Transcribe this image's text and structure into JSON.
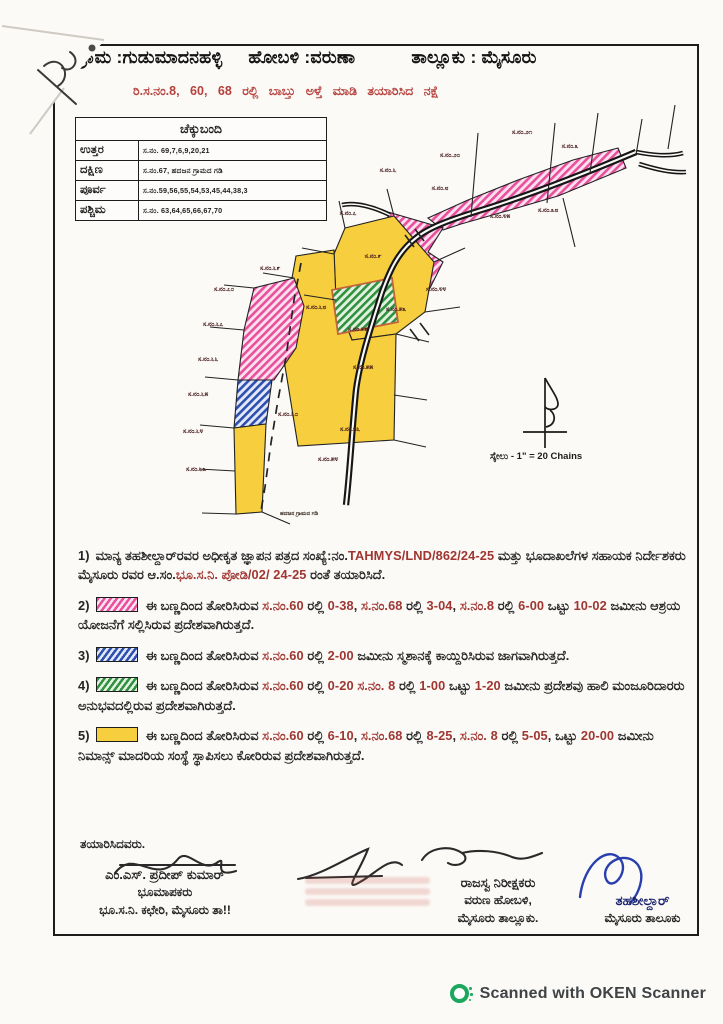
{
  "header": {
    "village": "ಗ್ರಾಮ :ಗುಡುಮಾದನಹಳ್ಳಿ",
    "hobli": "ಹೋಬಳಿ :ವರುಣಾ",
    "taluk": "ತಾಲ್ಲೂಕು : ಮೈಸೂರು",
    "subtitle": "ರಿ.ಸ.ನಂ.8, 60, 68 ರಲ್ಲಿ ಬಾಬ್ತು ಅಳ್ತೆ ಮಾಡಿ ತಯಾರಿಸಿದ ನಕ್ಷೆ"
  },
  "checkbandi": {
    "title": "ಚೆಕ್ಕುಬಂದಿ",
    "rows": [
      {
        "label": "ಉತ್ತರ",
        "value": "ಸ.ನಂ. 69,7,6,9,20,21"
      },
      {
        "label": "ದಕ್ಷಿಣ",
        "value": "ಸ.ನಂ.67, ಹದಜನ ಗ್ರಾಮದ ಗಡಿ"
      },
      {
        "label": "ಪೂರ್ವ",
        "value": "ಸ.ನಂ.59,56,55,54,53,45,44,38,3"
      },
      {
        "label": "ಪಶ್ಚಿಮ",
        "value": "ಸ.ನಂ. 63,64,65,66,67,70"
      }
    ]
  },
  "map": {
    "scale_label": "ಸ್ಕೇಲು - 1\" = 20 Chains",
    "boundary_note": "ಹದಜನ ಗ್ರಾಮದ ಗಡಿ",
    "colors": {
      "pink": "#e8509d",
      "blue": "#2f4fae",
      "green": "#2f9140",
      "yellow": "#f6ce3e"
    },
    "labels": [
      {
        "x": 330,
        "y": 77,
        "t": "ಸ.ನಂ.೬"
      },
      {
        "x": 392,
        "y": 62,
        "t": "ಸ.ನಂ.೨೦"
      },
      {
        "x": 464,
        "y": 39,
        "t": "ಸ.ನಂ.೨೧"
      },
      {
        "x": 512,
        "y": 53,
        "t": "ಸ.ನಂ.೩"
      },
      {
        "x": 290,
        "y": 120,
        "t": "ಸ.ನಂ.೭"
      },
      {
        "x": 382,
        "y": 95,
        "t": "ಸ.ನಂ.೮"
      },
      {
        "x": 442,
        "y": 123,
        "t": "ಸ.ನಂ.೪೫"
      },
      {
        "x": 490,
        "y": 117,
        "t": "ಸ.ನಂ.೩೮"
      },
      {
        "x": 378,
        "y": 196,
        "t": "ಸ.ನಂ.೪೪"
      },
      {
        "x": 315,
        "y": 163,
        "t": "ಸ.ನಂ.೯"
      },
      {
        "x": 212,
        "y": 175,
        "t": "ಸ.ನಂ.೬೯"
      },
      {
        "x": 166,
        "y": 196,
        "t": "ಸ.ನಂ.೭೦"
      },
      {
        "x": 155,
        "y": 231,
        "t": "ಸ.ನಂ.೬೭"
      },
      {
        "x": 150,
        "y": 266,
        "t": "ಸ.ನಂ.೬೬"
      },
      {
        "x": 140,
        "y": 301,
        "t": "ಸ.ನಂ.೬೫"
      },
      {
        "x": 135,
        "y": 338,
        "t": "ಸ.ನಂ.೬೪"
      },
      {
        "x": 138,
        "y": 376,
        "t": "ಸ.ನಂ.೬೩"
      },
      {
        "x": 258,
        "y": 214,
        "t": "ಸ.ನಂ.೬೮"
      },
      {
        "x": 230,
        "y": 321,
        "t": "ಸ.ನಂ.೬೦"
      },
      {
        "x": 338,
        "y": 216,
        "t": "ಸ.ನಂ.೫೩"
      },
      {
        "x": 300,
        "y": 236,
        "t": "ಸ.ನಂ.೫೯"
      },
      {
        "x": 305,
        "y": 274,
        "t": "ಸ.ನಂ.೫೫"
      },
      {
        "x": 292,
        "y": 336,
        "t": "ಸ.ನಂ.೫೬"
      },
      {
        "x": 270,
        "y": 366,
        "t": "ಸ.ನಂ.೫೪"
      }
    ]
  },
  "notes": [
    {
      "num": "1)",
      "swatch": null,
      "segments": [
        {
          "t": "ಮಾನ್ಯ ತಹಶೀಲ್ದಾರ್‌ರವರ ಅಧೀಕೃತ ಜ್ಞಾಪನ ಪತ್ರದ ಸಂಖ್ಯೆ:ನಂ.",
          "r": false
        },
        {
          "t": "TAHMYS/LND/862/24-25",
          "r": true
        },
        {
          "t": " ಮತ್ತು ಭೂದಾಖಲೆಗಳ ಸಹಾಯಕ ನಿರ್ದೇಶಕರು ಮೈಸೂರು ರವರ ಆ.ಸಂ.",
          "r": false
        },
        {
          "t": "ಭೂ.ಸ.ನಿ. ಪೋಡಿ/02/ 24-25",
          "r": true
        },
        {
          "t": " ರಂತೆ ತಯಾರಿಸಿದೆ.",
          "r": false
        }
      ]
    },
    {
      "num": "2)",
      "swatch": "pink",
      "segments": [
        {
          "t": "ಈ ಬಣ್ಣದಿಂದ ತೋರಿಸಿರುವ ",
          "r": false
        },
        {
          "t": "ಸ.ನಂ.60",
          "r": true
        },
        {
          "t": " ರಲ್ಲಿ ",
          "r": false
        },
        {
          "t": "0-38",
          "r": true
        },
        {
          "t": ", ",
          "r": false
        },
        {
          "t": "ಸ.ನಂ.68",
          "r": true
        },
        {
          "t": " ರಲ್ಲಿ ",
          "r": false
        },
        {
          "t": "3-04",
          "r": true
        },
        {
          "t": ", ",
          "r": false
        },
        {
          "t": "ಸ.ನಂ.8",
          "r": true
        },
        {
          "t": " ರಲ್ಲಿ ",
          "r": false
        },
        {
          "t": "6-00",
          "r": true
        },
        {
          "t": " ಒಟ್ಟು ",
          "r": false
        },
        {
          "t": "10-02",
          "r": true
        },
        {
          "t": " ಜಮೀನು ಆಶ್ರಯ ಯೋಜನೆಗೆ ಸಲ್ಲಿಸಿರುವ ಪ್ರದೇಶವಾಗಿರುತ್ತದೆ.",
          "r": false
        }
      ]
    },
    {
      "num": "3)",
      "swatch": "blue",
      "segments": [
        {
          "t": "ಈ ಬಣ್ಣದಿಂದ ತೋರಿಸಿರುವ ",
          "r": false
        },
        {
          "t": "ಸ.ನಂ.60",
          "r": true
        },
        {
          "t": " ರಲ್ಲಿ ",
          "r": false
        },
        {
          "t": "2-00",
          "r": true
        },
        {
          "t": " ಜಮೀನು ಸ್ಮಶಾನಕ್ಕೆ ಕಾಯ್ದಿರಿಸಿರುವ ಜಾಗವಾಗಿರುತ್ತದೆ.",
          "r": false
        }
      ]
    },
    {
      "num": "4)",
      "swatch": "green",
      "segments": [
        {
          "t": "ಈ ಬಣ್ಣದಿಂದ ತೋರಿಸಿರುವ ",
          "r": false
        },
        {
          "t": "ಸ.ನಂ.60",
          "r": true
        },
        {
          "t": " ರಲ್ಲಿ ",
          "r": false
        },
        {
          "t": "0-20",
          "r": true
        },
        {
          "t": " ",
          "r": false
        },
        {
          "t": "ಸ.ನಂ. 8",
          "r": true
        },
        {
          "t": " ರಲ್ಲಿ ",
          "r": false
        },
        {
          "t": "1-00",
          "r": true
        },
        {
          "t": " ಒಟ್ಟು ",
          "r": false
        },
        {
          "t": "1-20",
          "r": true
        },
        {
          "t": " ಜಮೀನು ಪ್ರದೇಶವು ಹಾಲಿ ಮಂಜೂರಿದಾರರು ಅನುಭವದಲ್ಲಿರುವ ಪ್ರದೇಶವಾಗಿರುತ್ತದೆ.",
          "r": false
        }
      ]
    },
    {
      "num": "5)",
      "swatch": "yellow",
      "segments": [
        {
          "t": "ಈ ಬಣ್ಣದಿಂದ ತೋರಿಸಿರುವ ",
          "r": false
        },
        {
          "t": "ಸ.ನಂ.60",
          "r": true
        },
        {
          "t": " ರಲ್ಲಿ ",
          "r": false
        },
        {
          "t": "6-10",
          "r": true
        },
        {
          "t": ", ",
          "r": false
        },
        {
          "t": "ಸ.ನಂ.68",
          "r": true
        },
        {
          "t": " ರಲ್ಲಿ ",
          "r": false
        },
        {
          "t": "8-25",
          "r": true
        },
        {
          "t": ", ",
          "r": false
        },
        {
          "t": "ಸ.ನಂ. 8",
          "r": true
        },
        {
          "t": " ರಲ್ಲಿ ",
          "r": false
        },
        {
          "t": "5-05",
          "r": true
        },
        {
          "t": ", ಒಟ್ಟು ",
          "r": false
        },
        {
          "t": "20-00",
          "r": true
        },
        {
          "t": " ಜಮೀನು ನಿಮಾನ್ಸ್ ಮಾದರಿಯ ಸಂಸ್ಥೆ ಸ್ಥಾಪಿಸಲು ಕೋರಿರುವ ಪ್ರದೇಶವಾಗಿರುತ್ತದೆ.",
          "r": false
        }
      ]
    }
  ],
  "signatures": {
    "prepared_by": "ತಯಾರಿಸಿದವರು.",
    "left": {
      "name": "ಎಂ.ಎಸ್. ಪ್ರದೀಪ್ ಕುಮಾರ್",
      "role": "ಭೂಮಾಪಕರು",
      "office": "ಭೂ.ಸ.ನಿ. ಕಛೇರಿ, ಮೈಸೂರು ತಾ!!"
    },
    "revenue_inspector": {
      "line1": "ರಾಜಸ್ವ ನಿರೀಕ್ಷಕರು",
      "line2": "ವರುಣ ಹೋಬಳಿ,",
      "line3": "ಮೈಸೂರು ತಾಲ್ಲೂಕು."
    },
    "tahsildar": {
      "line1": "ತಹಶೀಲ್ದಾರ್",
      "line2": "ಮೈಸೂರು ತಾಲೂಕು"
    }
  },
  "footer": {
    "scan_text": "Scanned with OKEN Scanner"
  }
}
